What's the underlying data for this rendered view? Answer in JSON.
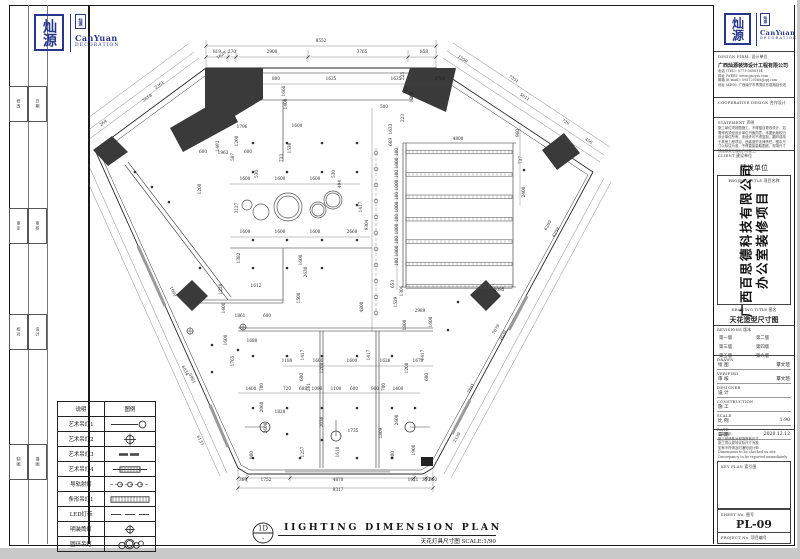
{
  "sheet": {
    "accent_blue": "#27358c",
    "line_color": "#1a1a1a",
    "wedge_color": "#3a3a3a"
  },
  "logo": {
    "seal_text": "灿源",
    "en_line1": "CanYuan",
    "en_line2": "DECORATION"
  },
  "margin": {
    "groups": [
      [
        "修改",
        "日期"
      ],
      [
        "审定",
        "审核"
      ],
      [
        "校对",
        "设计"
      ],
      [
        "制图",
        "描图"
      ]
    ]
  },
  "title_block": {
    "design_firm_label": "DESIGN FIRM:   设计单位",
    "firm_name": "广西灿源装饰设计工程有限公司",
    "contacts": [
      "电话 (TEL): 0771-5606114",
      "网址 (WEB): www.gxcyzs.com",
      "邮箱 (E-mail): 595720568@qq.com",
      "地址 (ADD): 广西南宁市青秀区东葛路延长线"
    ],
    "cooperative_label": "COOPERATIVE DESIGN   合作设计",
    "statement_label": "STATEMENT   声明",
    "statement_lines": [
      "施工单位须按图施工，不得擅自更改设计，如",
      "需修改须经设计单位书面同意。本图纸版权归",
      "设计单位所有，未经许可不得复制、翻印或用",
      "于其他工程项目，违者追究法律责任。图中尺",
      "寸以标注为准，不得直接量取图纸，现场尺寸",
      "须经核实无误后方可施工。"
    ],
    "client_label": "CLIENT   建设单位",
    "client_value": "建设单位",
    "project_title_label": "PROJECT TITLE   项目名称",
    "project_name_line1": "广西百思德科技有限公司",
    "project_name_line2": "办公室装修项目",
    "drawing_title_label": "DRAWING TITLE   图名",
    "drawing_title": "天花造型尺寸图",
    "revisions_label": "REVISIONS   版本",
    "revisions": [
      "第一版",
      "第二版",
      "第三版",
      "第四版",
      "第五版",
      "第六版"
    ],
    "info_rows": [
      {
        "en": "DRAWN",
        "cn": "绘 图",
        "val": "覃文瑄"
      },
      {
        "en": "VERIFIED",
        "cn": "审 核",
        "val": "覃文瑄"
      },
      {
        "en": "DESIGNER",
        "cn": "设 计",
        "val": ""
      },
      {
        "en": "CONSTRUCTION",
        "cn": "施 工",
        "val": ""
      },
      {
        "en": "SCALE",
        "cn": "比 例",
        "val": "1:90"
      },
      {
        "en": "DATE",
        "cn": "日 期",
        "val": "2020.12.12"
      }
    ],
    "notes_lines": [
      "温馨提示:",
      "施工前请核对现场所有尺寸",
      "施工须以现场实际尺寸为准",
      "如有不符请及时通知设计师",
      "Dimensions to be checked on site",
      "Discrepancy to be reported immediately"
    ],
    "key_plan_label": "KEY PLAN   索引图",
    "sheet_no_label": "SHEET No.   图号",
    "sheet_no": "PL-09",
    "project_no_label": "PROJECT No.   项目编号"
  },
  "legend": {
    "headers": [
      "说明",
      "图例"
    ],
    "rows": [
      {
        "label": "艺术吊灯1",
        "sym": "line-circle"
      },
      {
        "label": "艺术吊灯2",
        "sym": "cross-circle"
      },
      {
        "label": "艺术吊灯3",
        "sym": "dash-thick"
      },
      {
        "label": "艺术吊灯4",
        "sym": "capsule-hatch"
      },
      {
        "label": "导轨射灯",
        "sym": "dash-circles"
      },
      {
        "label": "条形吊灯1",
        "sym": "bar-hatch"
      },
      {
        "label": "LED灯带",
        "sym": "dashes"
      },
      {
        "label": "明装筒灯",
        "sym": "circle-plus"
      },
      {
        "label": "圆环吊灯",
        "sym": "rings"
      }
    ]
  },
  "caption": {
    "bubble_top": "1D",
    "bubble_bottom": "-",
    "title": "IIGHTING DIMENSION PLAN",
    "sub_cn": "天花灯具尺寸图",
    "scale": "SCALE:1/90"
  },
  "plan": {
    "labels": [
      [
        "8552",
        321,
        42,
        0
      ],
      [
        "819",
        217,
        53,
        0
      ],
      [
        "270",
        232,
        53,
        0
      ],
      [
        "2900",
        272,
        53,
        0
      ],
      [
        "3765",
        362,
        53,
        0
      ],
      [
        "858",
        424,
        53,
        0
      ],
      [
        "1629",
        222,
        56,
        -36
      ],
      [
        "2361",
        160,
        86,
        -36
      ],
      [
        "3618",
        148,
        99,
        -36
      ],
      [
        "264",
        104,
        124,
        -36
      ],
      [
        "1550",
        462,
        60,
        33
      ],
      [
        "7351",
        513,
        80,
        33
      ],
      [
        "5611",
        524,
        98,
        33
      ],
      [
        "720",
        565,
        123,
        33
      ],
      [
        "450",
        588,
        142,
        33
      ],
      [
        "6269",
        549,
        226,
        -61
      ],
      [
        "6259",
        557,
        233,
        -61
      ],
      [
        "7679",
        497,
        330,
        -61
      ],
      [
        "2639",
        504,
        336,
        -61
      ],
      [
        "2861",
        472,
        389,
        -61
      ],
      [
        "2139",
        458,
        438,
        -61
      ],
      [
        "6034",
        184,
        371,
        64
      ],
      [
        "5961",
        191,
        379,
        64
      ],
      [
        "6137",
        199,
        441,
        64
      ],
      [
        "1060",
        172,
        292,
        64
      ],
      [
        "360",
        243,
        481,
        0
      ],
      [
        "1752",
        266,
        481,
        0
      ],
      [
        "4870",
        338,
        481,
        0
      ],
      [
        "1621",
        413,
        481,
        0
      ],
      [
        "350",
        426,
        481,
        0
      ],
      [
        "360",
        433,
        481,
        0
      ],
      [
        "9317",
        338,
        491,
        0
      ],
      [
        "800",
        276,
        80,
        0
      ],
      [
        "1666",
        285,
        91,
        -90
      ],
      [
        "1635",
        331,
        80,
        0
      ],
      [
        "1635",
        396,
        80,
        0
      ],
      [
        "1766",
        440,
        80,
        0
      ],
      [
        "1400",
        287,
        104,
        -90
      ],
      [
        "1600",
        297,
        127,
        0
      ],
      [
        "500",
        384,
        108,
        0
      ],
      [
        "385",
        407,
        90,
        -90
      ],
      [
        "1200",
        413,
        97,
        -90
      ],
      [
        "225",
        404,
        76,
        -90
      ],
      [
        "223",
        404,
        118,
        -90
      ],
      [
        "1633",
        392,
        129,
        -90
      ],
      [
        "669",
        392,
        142,
        -90
      ],
      [
        "4800",
        458,
        140,
        0
      ],
      [
        "960",
        519,
        133,
        -90
      ],
      [
        "737",
        522,
        160,
        -90
      ],
      [
        "2400",
        525,
        192,
        -90
      ],
      [
        "100",
        398,
        152,
        -90
      ],
      [
        "1000",
        398,
        163,
        -90
      ],
      [
        "100",
        398,
        174,
        -90
      ],
      [
        "1000",
        398,
        185,
        -90
      ],
      [
        "100",
        398,
        196,
        -90
      ],
      [
        "1000",
        398,
        207,
        -90
      ],
      [
        "100",
        398,
        218,
        -90
      ],
      [
        "1000",
        398,
        229,
        -90
      ],
      [
        "100",
        398,
        240,
        -90
      ],
      [
        "1000",
        398,
        251,
        -90
      ],
      [
        "100",
        398,
        262,
        -90
      ],
      [
        "1529",
        397,
        302,
        -90
      ],
      [
        "9304",
        368,
        225,
        -90
      ],
      [
        "1796",
        242,
        128,
        0
      ],
      [
        "1200",
        238,
        141,
        -90
      ],
      [
        "1493",
        219,
        146,
        -90
      ],
      [
        "600",
        203,
        153,
        0
      ],
      [
        "1963",
        223,
        154,
        0
      ],
      [
        "587",
        234,
        157,
        -90
      ],
      [
        "600",
        248,
        153,
        0
      ],
      [
        "733",
        283,
        158,
        -90
      ],
      [
        "1530",
        291,
        148,
        -90
      ],
      [
        "530",
        258,
        174,
        -90
      ],
      [
        "1600",
        245,
        180,
        0
      ],
      [
        "1600",
        280,
        180,
        0
      ],
      [
        "1600",
        315,
        180,
        0
      ],
      [
        "530",
        335,
        174,
        -90
      ],
      [
        "494",
        341,
        184,
        -90
      ],
      [
        "1200",
        201,
        189,
        -90
      ],
      [
        "3127",
        238,
        208,
        -90
      ],
      [
        "1417",
        362,
        207,
        -90
      ],
      [
        "1600",
        245,
        233,
        0
      ],
      [
        "1600",
        280,
        233,
        0
      ],
      [
        "1600",
        315,
        233,
        0
      ],
      [
        "2660",
        352,
        233,
        0
      ],
      [
        "1382",
        240,
        258,
        -90
      ],
      [
        "1600",
        302,
        260,
        -90
      ],
      [
        "2630",
        307,
        272,
        -90
      ],
      [
        "1228",
        222,
        289,
        -90
      ],
      [
        "1612",
        256,
        287,
        0
      ],
      [
        "1861",
        240,
        317,
        0
      ],
      [
        "600",
        267,
        317,
        0
      ],
      [
        "1400",
        225,
        308,
        -90
      ],
      [
        "1600",
        227,
        340,
        -90
      ],
      [
        "1680",
        252,
        342,
        0
      ],
      [
        "1765",
        234,
        361,
        -90
      ],
      [
        "1500",
        300,
        298,
        -90
      ],
      [
        "4800",
        363,
        307,
        -90
      ],
      [
        "3095",
        499,
        291,
        0
      ],
      [
        "653",
        394,
        284,
        -90
      ],
      [
        "1306",
        403,
        291,
        -90
      ],
      [
        "2989",
        420,
        312,
        0
      ],
      [
        "1600",
        432,
        322,
        -90
      ],
      [
        "1800",
        406,
        325,
        -90
      ],
      [
        "1180",
        287,
        362,
        0
      ],
      [
        "1600",
        318,
        362,
        0
      ],
      [
        "1600",
        352,
        362,
        0
      ],
      [
        "1628",
        385,
        362,
        0
      ],
      [
        "1678",
        418,
        362,
        0
      ],
      [
        "1417",
        304,
        355,
        -90
      ],
      [
        "1417",
        370,
        355,
        -90
      ],
      [
        "1417",
        424,
        355,
        -90
      ],
      [
        "1208",
        323,
        368,
        -90
      ],
      [
        "1208",
        408,
        368,
        -90
      ],
      [
        "600",
        303,
        377,
        -90
      ],
      [
        "600",
        428,
        377,
        -90
      ],
      [
        "1400",
        251,
        390,
        0
      ],
      [
        "700",
        263,
        387,
        -90
      ],
      [
        "720",
        287,
        390,
        0
      ],
      [
        "608",
        303,
        390,
        0
      ],
      [
        "261",
        310,
        387,
        -90
      ],
      [
        "1096",
        317,
        390,
        0
      ],
      [
        "1100",
        336,
        390,
        0
      ],
      [
        "600",
        354,
        390,
        0
      ],
      [
        "900",
        375,
        390,
        0
      ],
      [
        "700",
        385,
        387,
        -90
      ],
      [
        "1400",
        398,
        390,
        0
      ],
      [
        "2060",
        263,
        407,
        -90
      ],
      [
        "1828",
        280,
        413,
        0
      ],
      [
        "2600",
        267,
        428,
        -90
      ],
      [
        "2036",
        323,
        422,
        -90
      ],
      [
        "1735",
        353,
        432,
        0
      ],
      [
        "1809",
        382,
        433,
        -90
      ],
      [
        "1618",
        339,
        452,
        -90
      ],
      [
        "1257",
        304,
        452,
        -90
      ],
      [
        "1900",
        415,
        450,
        -90
      ],
      [
        "900",
        253,
        455,
        -90
      ],
      [
        "900",
        394,
        455,
        -90
      ],
      [
        "2600",
        398,
        420,
        -90
      ]
    ],
    "dots": [
      [
        253,
        143
      ],
      [
        287,
        143
      ],
      [
        322,
        143
      ],
      [
        357,
        143
      ],
      [
        253,
        172
      ],
      [
        287,
        172
      ],
      [
        322,
        172
      ],
      [
        357,
        172
      ],
      [
        357,
        205
      ],
      [
        253,
        240
      ],
      [
        287,
        240
      ],
      [
        322,
        240
      ],
      [
        357,
        240
      ],
      [
        253,
        268
      ],
      [
        287,
        268
      ],
      [
        322,
        268
      ],
      [
        135,
        172
      ],
      [
        152,
        187
      ],
      [
        169,
        202
      ],
      [
        200,
        268
      ],
      [
        212,
        345
      ],
      [
        238,
        350
      ],
      [
        212,
        372
      ],
      [
        253,
        356
      ],
      [
        287,
        356
      ],
      [
        322,
        356
      ],
      [
        357,
        356
      ],
      [
        392,
        356
      ],
      [
        253,
        408
      ],
      [
        287,
        408
      ],
      [
        322,
        408
      ],
      [
        357,
        408
      ],
      [
        392,
        408
      ],
      [
        415,
        408
      ],
      [
        287,
        434
      ],
      [
        322,
        440
      ],
      [
        253,
        458
      ],
      [
        300,
        458
      ],
      [
        357,
        458
      ],
      [
        392,
        458
      ],
      [
        448,
        330
      ],
      [
        458,
        302
      ],
      [
        524,
        170
      ]
    ],
    "open_circles": [
      [
        376,
        153
      ],
      [
        376,
        169
      ],
      [
        376,
        185
      ],
      [
        376,
        201
      ],
      [
        376,
        217
      ],
      [
        376,
        233
      ],
      [
        376,
        249
      ],
      [
        376,
        265
      ],
      [
        376,
        281
      ],
      [
        376,
        297
      ],
      [
        376,
        313
      ]
    ],
    "plus_marks": [
      [
        243,
        327
      ],
      [
        190,
        331
      ]
    ],
    "pendants": [
      [
        265,
        427,
        -20,
        0
      ],
      [
        336,
        436,
        0,
        -16
      ],
      [
        410,
        427,
        20,
        0
      ]
    ],
    "rings": [
      [
        247,
        205,
        5
      ],
      [
        261,
        212,
        8
      ],
      [
        288,
        207,
        14
      ],
      [
        288,
        207,
        11
      ],
      [
        318,
        210,
        8
      ],
      [
        318,
        210,
        6
      ],
      [
        333,
        200,
        9
      ],
      [
        333,
        200,
        7
      ]
    ],
    "bar_room": {
      "bars": 7,
      "dim": "4800"
    }
  }
}
